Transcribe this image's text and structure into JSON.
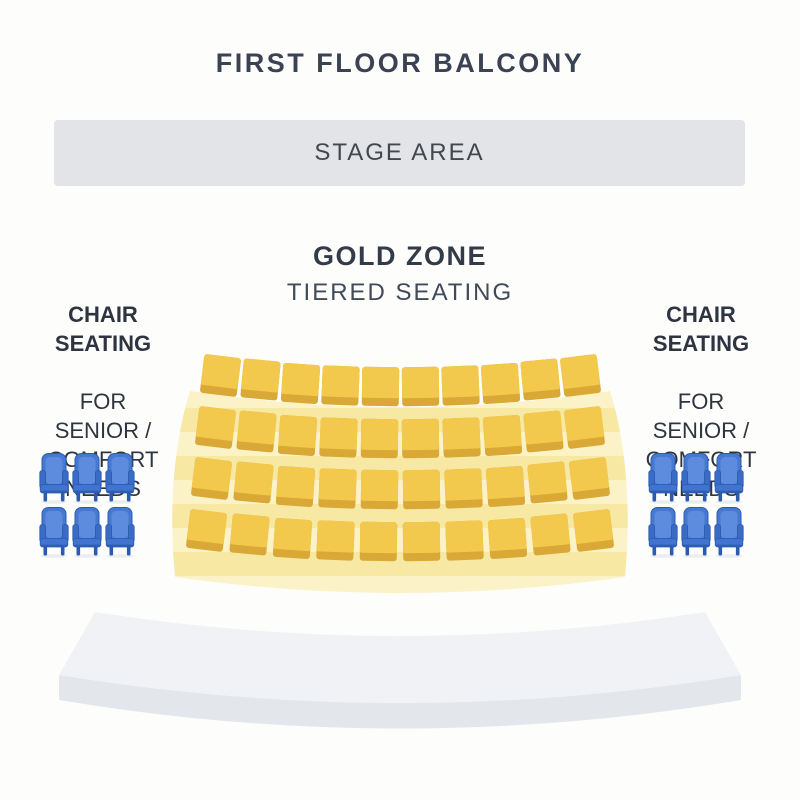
{
  "background": "#FDFDFC",
  "page": {
    "title": "FIRST FLOOR BALCONY"
  },
  "stage": {
    "label": "STAGE AREA",
    "fill": "#E2E4E8"
  },
  "gold_zone": {
    "title": "GOLD ZONE",
    "subtitle": "TIERED SEATING",
    "rows": 4,
    "seats_per_row": 10,
    "colors": {
      "seat_top": "#F3C94D",
      "seat_front": "#D9A836",
      "tier_light": "#FBF3C7",
      "tier_dark": "#F7E8A3"
    }
  },
  "side_sections": {
    "left": {
      "heading_lines": [
        "CHAIR",
        "SEATING"
      ],
      "body_lines": [
        "FOR",
        "SENIOR /",
        "COMFORT",
        "NEEDS"
      ],
      "chair_rows": 2,
      "chair_cols": 3
    },
    "right": {
      "heading_lines": [
        "CHAIR",
        "SEATING"
      ],
      "body_lines": [
        "FOR",
        "SENIOR /",
        "COMFORT",
        "NEEDS"
      ],
      "chair_rows": 2,
      "chair_cols": 3
    },
    "chair_colors": {
      "main": "#4679D2",
      "inner": "#5D8CDF",
      "arm": "#3A6CC6",
      "seat": "#4074CE",
      "outline": "#2B5AAF",
      "shadow": "#EAECEF"
    }
  },
  "balcony_edge": {
    "top_color": "#F0F2F5",
    "front_color": "#E3E6EB"
  }
}
